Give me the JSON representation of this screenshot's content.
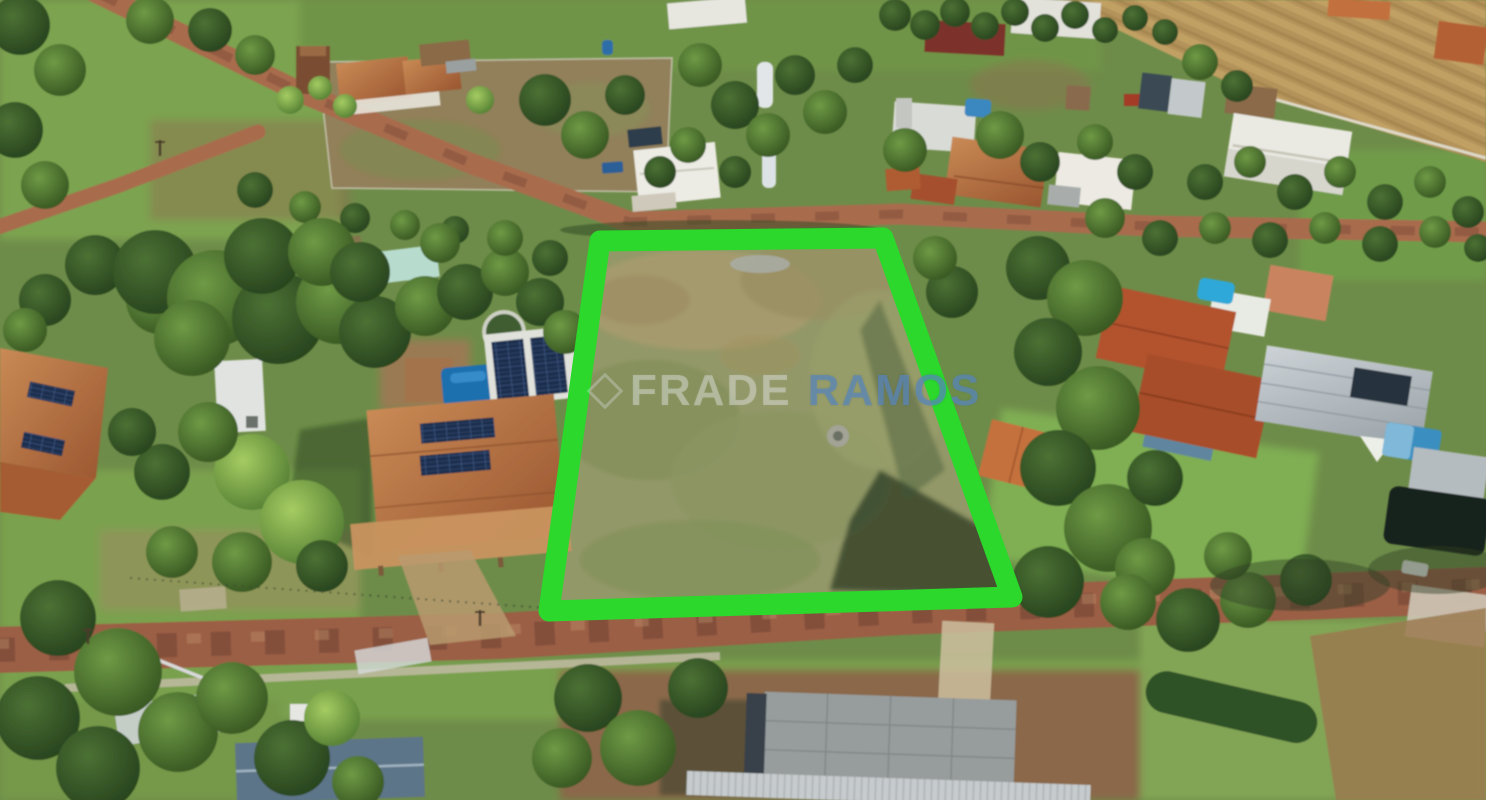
{
  "photo": {
    "kind": "aerial-drone-photo",
    "subject": "vacant residential land lot outlined in green in a rural condominium"
  },
  "watermark": {
    "icon": "diamond-outline",
    "brand_left": "FRADE",
    "brand_right": "RAMOS"
  },
  "lot_overlay": {
    "points": "600,241 883,238 1012,597 549,611",
    "stroke_width": 21
  },
  "palette": {
    "outlineGreen": "#2bd82b",
    "wmLeft": "rgba(228,231,234,0.38)",
    "wmRight": "rgba(90,137,193,0.66)",
    "grassBase": "#6e8c49",
    "grassLight": "#7ca34f",
    "lawnBright": "#7fae52",
    "treeDark": "#274420",
    "treeMid": "#3d5f2b",
    "treeLight": "#7fb04b",
    "dirtRoad": "#a86c4e",
    "dirtRoadDark": "#7a4a36",
    "bottomRoad": "#9b5e45",
    "fieldTan": "#bb9a5f",
    "paddockDry": "#91805a",
    "lotGrass": "#939868",
    "lotDry": "#a89b6e",
    "roofTerracotta": "#b4673f",
    "roofRed": "#b0522c",
    "roofMaroon": "#7c332a",
    "roofGray": "#b7bfc4",
    "roofWhite": "#eae9e2",
    "roofSlate": "#5d7488",
    "solarPanel": "#1e2f4e",
    "poolBlue": "#1b6fae",
    "poolLight": "#2fa8d8",
    "concrete": "#cfc7b6",
    "shadowGreen": "#243a1f"
  }
}
